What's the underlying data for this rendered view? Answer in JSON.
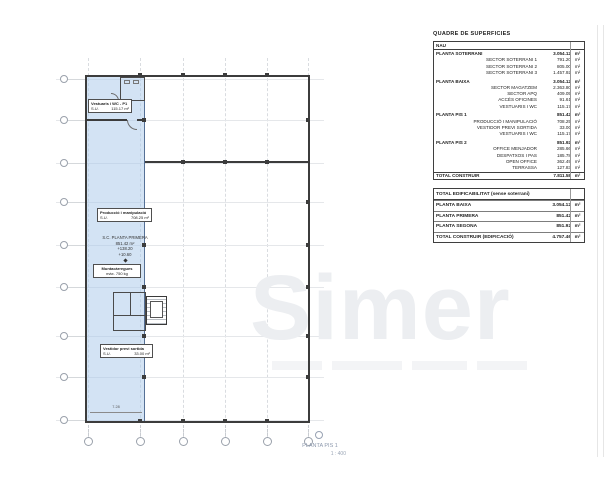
{
  "watermark": {
    "text": "Simer"
  },
  "plan": {
    "title": "PLANTA PIS 1",
    "scale": "1 : 400",
    "labels": {
      "vestuaris_title": "Vestuaris i WC - P1",
      "vestuaris_tag": "S.U.",
      "vestuaris_area": "115.17 m²",
      "produccio_title": "Producció i manipulació",
      "produccio_tag": "S.U.",
      "produccio_area": "708.25 m²",
      "sc_lines": [
        "S.C. PLANTA PRIMERA",
        "851.42 m²",
        "+138.20",
        "+10.60"
      ],
      "munta_title": "Muntacàrregues",
      "munta_note": "màx. 750 kg",
      "vestidor_title": "Vestidor previ sortida",
      "vestidor_tag": "S.U.",
      "vestidor_area": "33.00 m²",
      "dim_width": "7.28"
    }
  },
  "surfaces_table": {
    "title": "QUADRE DE SUPERFICIES",
    "group_header": "NAU",
    "unit": "m²",
    "rows": [
      {
        "label": "PLANTA SOTERRANI",
        "value": "3.054.12"
      },
      {
        "label": "SECTOR SOTERRANI 1",
        "value": "791.20"
      },
      {
        "label": "SECTOR SOTERRANI 2",
        "value": "805.00"
      },
      {
        "label": "SECTOR SOTERRANI 3",
        "value": "1.457.92"
      },
      {
        "label": "PLANTA BAIXA",
        "value": "3.054.12"
      },
      {
        "label": "SECTOR MAGATZEM",
        "value": "2.363.80"
      },
      {
        "label": "SECTOR APQ",
        "value": "409.05"
      },
      {
        "label": "ACCÉS OFICINES",
        "value": "91.61"
      },
      {
        "label": "VESTUARIS I WC",
        "value": "115.17"
      },
      {
        "label": "PLANTA PIS 1",
        "value": "851.42"
      },
      {
        "label": "PRODUCCIÓ I MANIPULACIÓ",
        "value": "708.25"
      },
      {
        "label": "VESTIDOR PREVI SORTIDA",
        "value": "33.00"
      },
      {
        "label": "VESTUARIS I WC",
        "value": "115.17"
      },
      {
        "label": "PLANTA PIS 2",
        "value": "851.92"
      },
      {
        "label": "OFFICE MENJADOR",
        "value": "285.66"
      },
      {
        "label": "DESPATXOS I PAS",
        "value": "185.78"
      },
      {
        "label": "OPEN OFFICE",
        "value": "362.49"
      },
      {
        "label": "TERRASSA",
        "value": "127.83"
      }
    ],
    "total_label": "TOTAL CONSTRUIR",
    "total_value": "7.811.58"
  },
  "edificability_table": {
    "title": "TOTAL EDIFICABILITAT (sense soterrani)",
    "unit": "m²",
    "rows": [
      {
        "label": "PLANTA BAIXA",
        "value": "3.054.12"
      },
      {
        "label": "PLANTA PRIMERA",
        "value": "851.42"
      },
      {
        "label": "PLANTA SEGONA",
        "value": "851.92"
      }
    ],
    "total_label": "TOTAL CONSTRUIR (EDIFICACIÓ)",
    "total_value": "4.757.46"
  }
}
